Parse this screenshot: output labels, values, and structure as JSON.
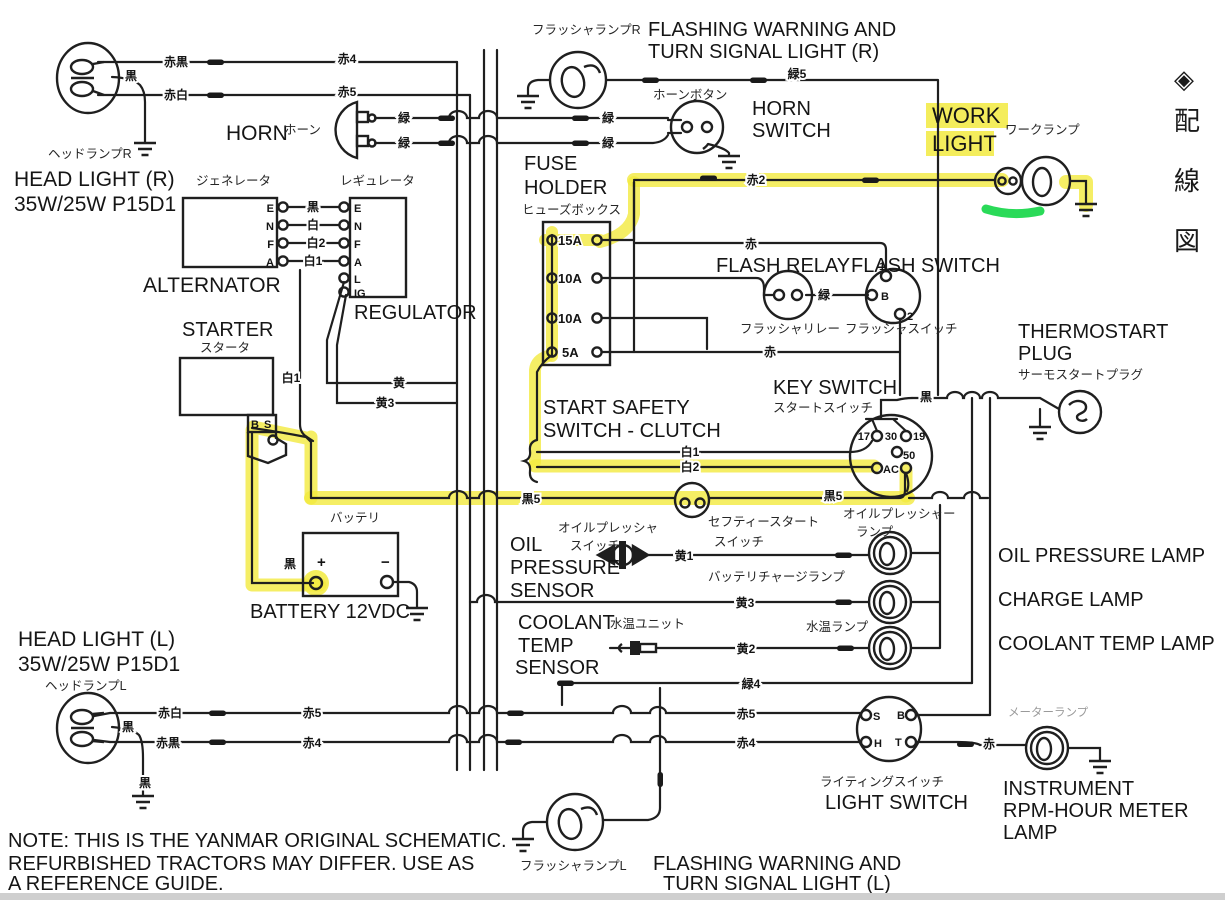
{
  "note": {
    "line1": "NOTE:  THIS IS THE YANMAR ORIGINAL SCHEMATIC.",
    "line2": "REFURBISHED TRACTORS MAY DIFFER.  USE AS",
    "line3": "A REFERENCE GUIDE."
  },
  "side_margin": {
    "symbol": "◈",
    "chars": [
      "配",
      "線",
      "図"
    ]
  },
  "components": {
    "head_light_r": {
      "jp": "ヘッドランプR",
      "en1": "HEAD LIGHT (R)",
      "en2": "35W/25W  P15D1"
    },
    "head_light_l": {
      "jp": "ヘッドランプL",
      "en1": "HEAD LIGHT (L)",
      "en2": "35W/25W  P15D1"
    },
    "horn": {
      "en": "HORN",
      "jp": "ホーン"
    },
    "flasher_r": {
      "jp": "フラッシャランプR",
      "en1": "FLASHING WARNING AND",
      "en2": "TURN SIGNAL LIGHT (R)"
    },
    "flasher_l": {
      "jp": "フラッシャランプL",
      "en1": "FLASHING WARNING AND",
      "en2": "TURN SIGNAL LIGHT (L)"
    },
    "horn_switch": {
      "jp": "ホーンボタン",
      "en1": "HORN",
      "en2": "SWITCH"
    },
    "work_light": {
      "en1": "WORK",
      "en2": "LIGHT",
      "jp": "ワークランプ"
    },
    "fuse_holder": {
      "en1": "FUSE",
      "en2": "HOLDER",
      "jp": "ヒューズボックス",
      "fuses": [
        "15A",
        "10A",
        "10A",
        "5A"
      ]
    },
    "flash_relay": {
      "en": "FLASH RELAY",
      "jp": "フラッシャリレー"
    },
    "flash_switch": {
      "en": "FLASH SWITCH",
      "jp": "フラッシャスイッチ",
      "terminals": [
        "1",
        "B",
        "2"
      ]
    },
    "thermostart": {
      "en1": "THERMOSTART",
      "en2": "PLUG",
      "jp": "サーモスタートプラグ"
    },
    "alternator": {
      "en": "ALTERNATOR",
      "jp": "ジェネレータ",
      "pins": [
        "E",
        "N",
        "F",
        "A"
      ]
    },
    "regulator": {
      "en": "REGULATOR",
      "jp": "レギュレータ",
      "pins": [
        "E",
        "N",
        "F",
        "A",
        "L",
        "IG"
      ]
    },
    "starter": {
      "en": "STARTER",
      "jp": "スタータ",
      "terminals": [
        "B",
        "S"
      ]
    },
    "key_switch": {
      "en": "KEY SWITCH",
      "jp": "スタートスイッチ",
      "terminals": [
        "17",
        "30",
        "19",
        "50",
        "AC"
      ]
    },
    "start_safety": {
      "en1": "START SAFETY",
      "en2": "SWITCH - CLUTCH"
    },
    "safety_start_switch": {
      "jp1": "セフティースタート",
      "jp2": "スイッチ"
    },
    "oil_pressure_sensor": {
      "en1": "OIL",
      "en2": "PRESSURE",
      "en3": "SENSOR",
      "jp1": "オイルプレッシャ",
      "jp2": "スイッチ"
    },
    "battery": {
      "jp": "バッテリ",
      "en": "BATTERY 12VDC",
      "plus": "+",
      "minus": "−"
    },
    "coolant_sensor": {
      "en1": "COOLANT",
      "en2": "TEMP",
      "en3": "SENSOR",
      "jp": "水温ユニット"
    },
    "oil_pressure_lamp": {
      "en": "OIL PRESSURE LAMP",
      "jp1": "オイルプレッシャー",
      "jp2": "ランプ"
    },
    "charge_lamp": {
      "en": "CHARGE LAMP",
      "jp": "バッテリチャージランプ"
    },
    "coolant_lamp": {
      "en": "COOLANT TEMP LAMP",
      "jp": "水温ランプ"
    },
    "light_switch": {
      "en": "LIGHT SWITCH",
      "jp": "ライティングスイッチ",
      "terminals": [
        "S",
        "B",
        "H",
        "T"
      ]
    },
    "instrument_lamp": {
      "en1": "INSTRUMENT",
      "en2": "RPM-HOUR METER",
      "en3": "LAMP",
      "jp": "メーターランプ"
    }
  },
  "wire_labels": [
    "赤黒",
    "赤4",
    "赤白",
    "赤5",
    "黒",
    "緑",
    "緑",
    "緑",
    "緑",
    "緑5",
    "赤2",
    "赤",
    "緑",
    "赤",
    "黒",
    "白",
    "白2",
    "白1",
    "白1",
    "黄",
    "黄3",
    "黒",
    "白1",
    "白2",
    "黒5",
    "黒5",
    "黒",
    "黄1",
    "黄3",
    "黄2",
    "緑4",
    "赤5",
    "赤4",
    "赤白",
    "赤5",
    "赤黒",
    "赤4",
    "黒",
    "黒",
    "赤"
  ],
  "colors": {
    "highlight": "#f2ea3f",
    "green_marker": "#1fd84f",
    "line": "#1f1f1f"
  }
}
